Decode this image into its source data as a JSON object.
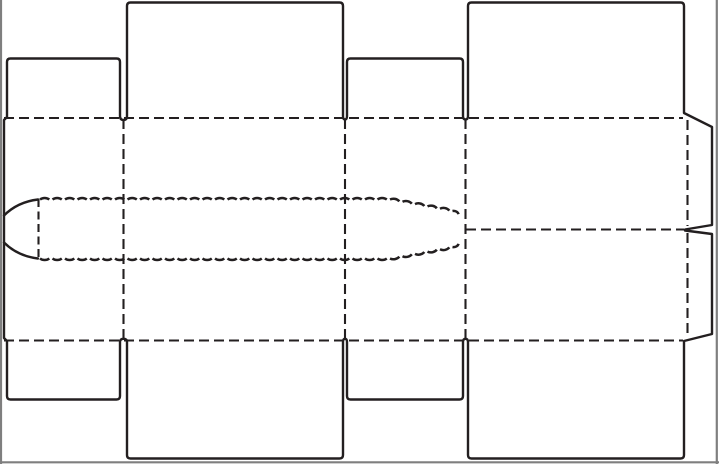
{
  "diagram": {
    "kind": "box-dieline",
    "line_styles": {
      "cut": "solid",
      "fold": "dashed",
      "tear_strip": "scalloped-perforation"
    }
  },
  "colors": {
    "background": "#ffffff",
    "cut_line": "#231f20",
    "fold_line": "#231f20",
    "tear_line": "#231f20",
    "frame": "#7f7f7f"
  }
}
